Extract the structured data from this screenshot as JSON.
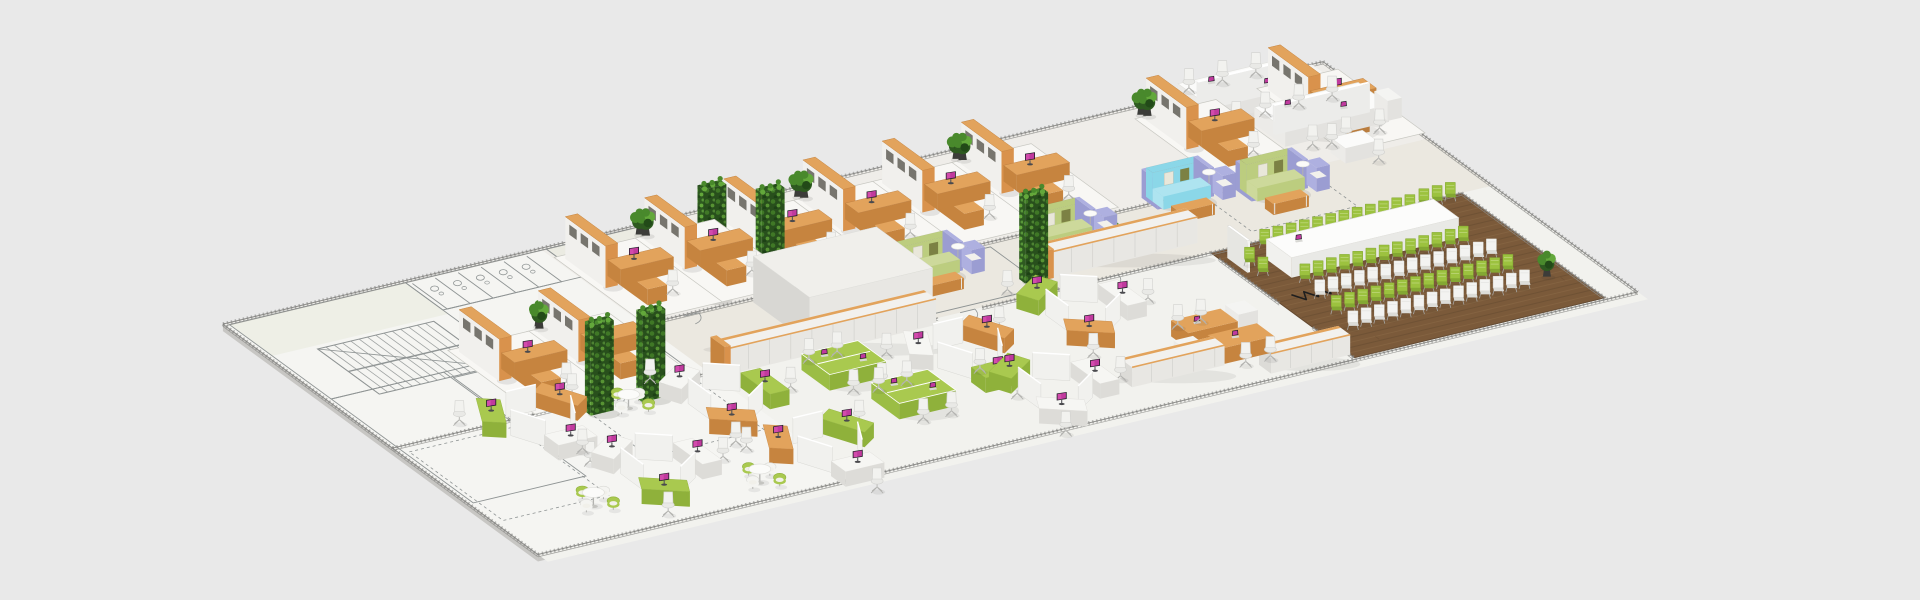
{
  "scene": {
    "background": "#e9e9e9",
    "projection": {
      "ox": 365,
      "oy": 300,
      "ux": 0.88,
      "uy": -0.21,
      "vx": 0.67,
      "vy": 0.49
    },
    "palette": {
      "bg": "#e9e9e9",
      "slabSideFront": "#c7c6c3",
      "slabSideRight": "#d3d2cf",
      "bandFloor": "#efede9",
      "corridorFloor": "#ebe8e0",
      "hexFloor": "#f2f2ee",
      "leftTint": "#f5f5f2",
      "roomTint": "#e7e9dd",
      "matFill": "#f8f7f4",
      "matStroke": "#c8c8c2",
      "blueprint": "#8f9494",
      "wallHatch": "#7e7e7b",
      "wallLine": "#8e8e8b",
      "wood": "#7b5a3a",
      "woodLight": "#8d6b47",
      "woodDark": "#634930",
      "orangeTop": "#e2a35c",
      "orangeSide": "#c6843f",
      "orangeEnd": "#d9924c",
      "white": "#f7f7f5",
      "whiteFront": "#e3e2df",
      "whiteSide": "#ecebe8",
      "cubby": "#77756e",
      "greenChair": "#9cc23f",
      "greenChairLight": "#c2d981",
      "whiteChair": "#f3f3f1",
      "podGreenTop": "#a9c94f",
      "podGreenSide": "#8fb13b",
      "sofaGreen": "#bccd7f",
      "sofaGreenSeat": "#cdd99b",
      "sofaBlue": "#8bd7e8",
      "sofaBlueSeat": "#aee4f0",
      "lilac": "#aeb0e0",
      "cushionOlive": "#7c8144",
      "cushionPale": "#e9e7da",
      "leafDark": "#2e5a20",
      "leafMid": "#49892c",
      "leafLight": "#63a83b",
      "pot": "#3c3c39",
      "screenPurple": "#c03a9e",
      "screenGlow": "#e05ab8",
      "monitorFrame": "#1d1d24",
      "chairSeat": "#e9e9e6",
      "chairBack": "#f2f2ef",
      "chairEdge": "#d2d2cf",
      "legGray": "#b3b3b0",
      "cable": "#1f1f1f"
    },
    "slab": {
      "u": -150,
      "v": -15,
      "w": 1250,
      "d": 470,
      "side": 7
    },
    "zones": {
      "band": [
        -150,
        -15,
        1250,
        157
      ],
      "corridor": [
        -150,
        142,
        1250,
        96
      ],
      "hex": [
        -150,
        238,
        1250,
        232
      ],
      "leftTint": [
        -150,
        -13,
        360,
        466
      ]
    },
    "blueprint": {
      "rooms": [
        [
          -145,
          -12,
          200,
          152
        ],
        [
          -145,
          140,
          128,
          212
        ],
        [
          55,
          -12,
          160,
          56
        ],
        [
          215,
          -12,
          105,
          108
        ],
        [
          -15,
          152,
          212,
          86
        ],
        [
          470,
          148,
          128,
          82
        ]
      ],
      "tintRooms": [
        [
          -145,
          -12,
          200,
          64
        ],
        [
          215,
          -12,
          105,
          60
        ]
      ],
      "stairs": {
        "u": -98,
        "v": 58,
        "w": 132,
        "d": 92,
        "steps": 14
      },
      "stalls": {
        "u": 60,
        "v": -8,
        "n": 6,
        "pitch": 26,
        "d": 52
      },
      "doors": [
        [
          60,
          140,
          14
        ],
        [
          140,
          140,
          14
        ],
        [
          255,
          142,
          16
        ],
        [
          480,
          140,
          15
        ],
        [
          545,
          140,
          15
        ],
        [
          -40,
          238,
          16
        ],
        [
          95,
          238,
          16
        ],
        [
          495,
          238,
          17
        ],
        [
          660,
          238,
          15
        ]
      ],
      "dashRects": [
        [
          60,
          246,
          130,
          100
        ],
        [
          -140,
          250,
          120,
          140
        ],
        [
          840,
          150,
          120,
          70
        ]
      ]
    },
    "walls": [
      [
        -150,
        -15,
        1100,
        -15
      ],
      [
        1100,
        -15,
        1100,
        455
      ],
      [
        -150,
        455,
        1100,
        455
      ],
      [
        -150,
        -15,
        -150,
        455
      ],
      [
        205,
        140,
        470,
        140
      ],
      [
        560,
        140,
        930,
        140
      ],
      [
        -150,
        238,
        470,
        238
      ],
      [
        520,
        238,
        780,
        238
      ],
      [
        780,
        238,
        1065,
        238
      ],
      [
        780,
        250,
        780,
        340
      ],
      [
        780,
        390,
        780,
        452
      ],
      [
        1065,
        238,
        1065,
        452
      ]
    ],
    "furniture": {
      "cubicles": [
        {
          "u": 220,
          "v": 8,
          "p": false
        },
        {
          "u": 310,
          "v": 8,
          "p": true
        },
        {
          "u": 400,
          "v": 8,
          "p": false
        },
        {
          "u": 490,
          "v": 8,
          "p": true
        },
        {
          "u": 580,
          "v": 8,
          "p": false
        },
        {
          "u": 670,
          "v": 8,
          "p": true
        },
        {
          "u": 880,
          "v": 8,
          "p": true
        },
        {
          "u": 1020,
          "v": 6,
          "p": false
        },
        {
          "u": 20,
          "v": 112,
          "p": false
        },
        {
          "u": 110,
          "v": 112,
          "p": true
        }
      ],
      "benchDesks": [
        [
          930,
          -8
        ],
        [
          968,
          56
        ]
      ],
      "meetingTables": [
        [
          1000,
          128
        ]
      ],
      "sofas": [
        {
          "u": 488,
          "v": 150,
          "c": "green"
        },
        {
          "u": 790,
          "v": 128,
          "c": "blue"
        },
        {
          "u": 640,
          "v": 148,
          "c": "green"
        },
        {
          "u": 880,
          "v": 150,
          "c": "green"
        }
      ],
      "cabinets": [
        {
          "u": 225,
          "v": 230,
          "w": 235,
          "h": 26,
          "end": true
        },
        {
          "u": 615,
          "v": 200,
          "w": 165,
          "h": 26,
          "end": true
        },
        {
          "u": 555,
          "v": 398,
          "w": 105,
          "h": 20,
          "end": false
        },
        {
          "u": 690,
          "v": 428,
          "w": 90,
          "h": 20,
          "end": false
        }
      ],
      "wallBlocks": [
        [
          330,
          146,
          140,
          84,
          46
        ]
      ],
      "greenWalls": [
        [
          118,
          250,
          88
        ],
        [
          288,
          118,
          112
        ],
        [
          348,
          126,
          100
        ],
        [
          585,
          208,
          86
        ],
        [
          58,
          252,
          90
        ]
      ],
      "plants": [
        [
          312,
          0
        ],
        [
          492,
          0
        ],
        [
          672,
          0
        ],
        [
          882,
          0
        ],
        [
          118,
          104
        ],
        [
          462,
          96
        ],
        [
          1040,
          398
        ]
      ],
      "plantRows": [
        [
          242,
          240,
          3
        ],
        [
          680,
          188,
          3
        ],
        [
          368,
          140,
          2
        ]
      ],
      "pods": [
        {
          "u": 0,
          "v": 262,
          "c": [
            "white",
            "green",
            "orange"
          ],
          "r": 0
        },
        {
          "u": 45,
          "v": 378,
          "c": [
            "green",
            "white",
            "white"
          ],
          "r": 1
        },
        {
          "u": 185,
          "v": 295,
          "c": [
            "orange",
            "white",
            "green"
          ],
          "r": 1
        },
        {
          "u": 215,
          "v": 408,
          "c": [
            "white",
            "orange",
            "green"
          ],
          "r": 0
        },
        {
          "u": 445,
          "v": 315,
          "c": [
            "green",
            "white",
            "orange"
          ],
          "r": 0
        },
        {
          "u": 480,
          "v": 400,
          "c": [
            "white",
            "green",
            "white"
          ],
          "r": 1
        },
        {
          "u": 595,
          "v": 290,
          "c": [
            "orange",
            "green",
            "white"
          ],
          "r": 1
        }
      ],
      "greenTables": [
        [
          292,
          268
        ],
        [
          318,
          338
        ]
      ],
      "orangeRows": [
        [
          648,
          352
        ]
      ],
      "cafeSets": [
        [
          100,
          262
        ],
        [
          -45,
          400
        ],
        [
          125,
          425
        ]
      ],
      "conference": {
        "floor": [
          780,
          238,
          285,
          214
        ],
        "table": [
          820,
          268,
          190,
          38
        ],
        "whiteboard": [
          788,
          252
        ],
        "rows": [
          {
            "u": 832,
            "v": 250,
            "n": 12,
            "c": "green"
          },
          {
            "u": 826,
            "v": 318,
            "n": 13,
            "c": "green"
          },
          {
            "u": 820,
            "v": 348,
            "n": 14,
            "c": "white"
          },
          {
            "u": 816,
            "v": 378,
            "n": 14,
            "c": "green"
          },
          {
            "u": 812,
            "v": 408,
            "n": 14,
            "c": "white"
          },
          {
            "u": 798,
            "v": 272,
            "n": 2,
            "dv": 20,
            "c": "green"
          },
          {
            "u": 1016,
            "v": 246,
            "n": 3,
            "c": "green"
          }
        ],
        "zigzags": [
          [
            800,
            332,
            6
          ],
          [
            950,
            298,
            5
          ]
        ]
      }
    }
  }
}
